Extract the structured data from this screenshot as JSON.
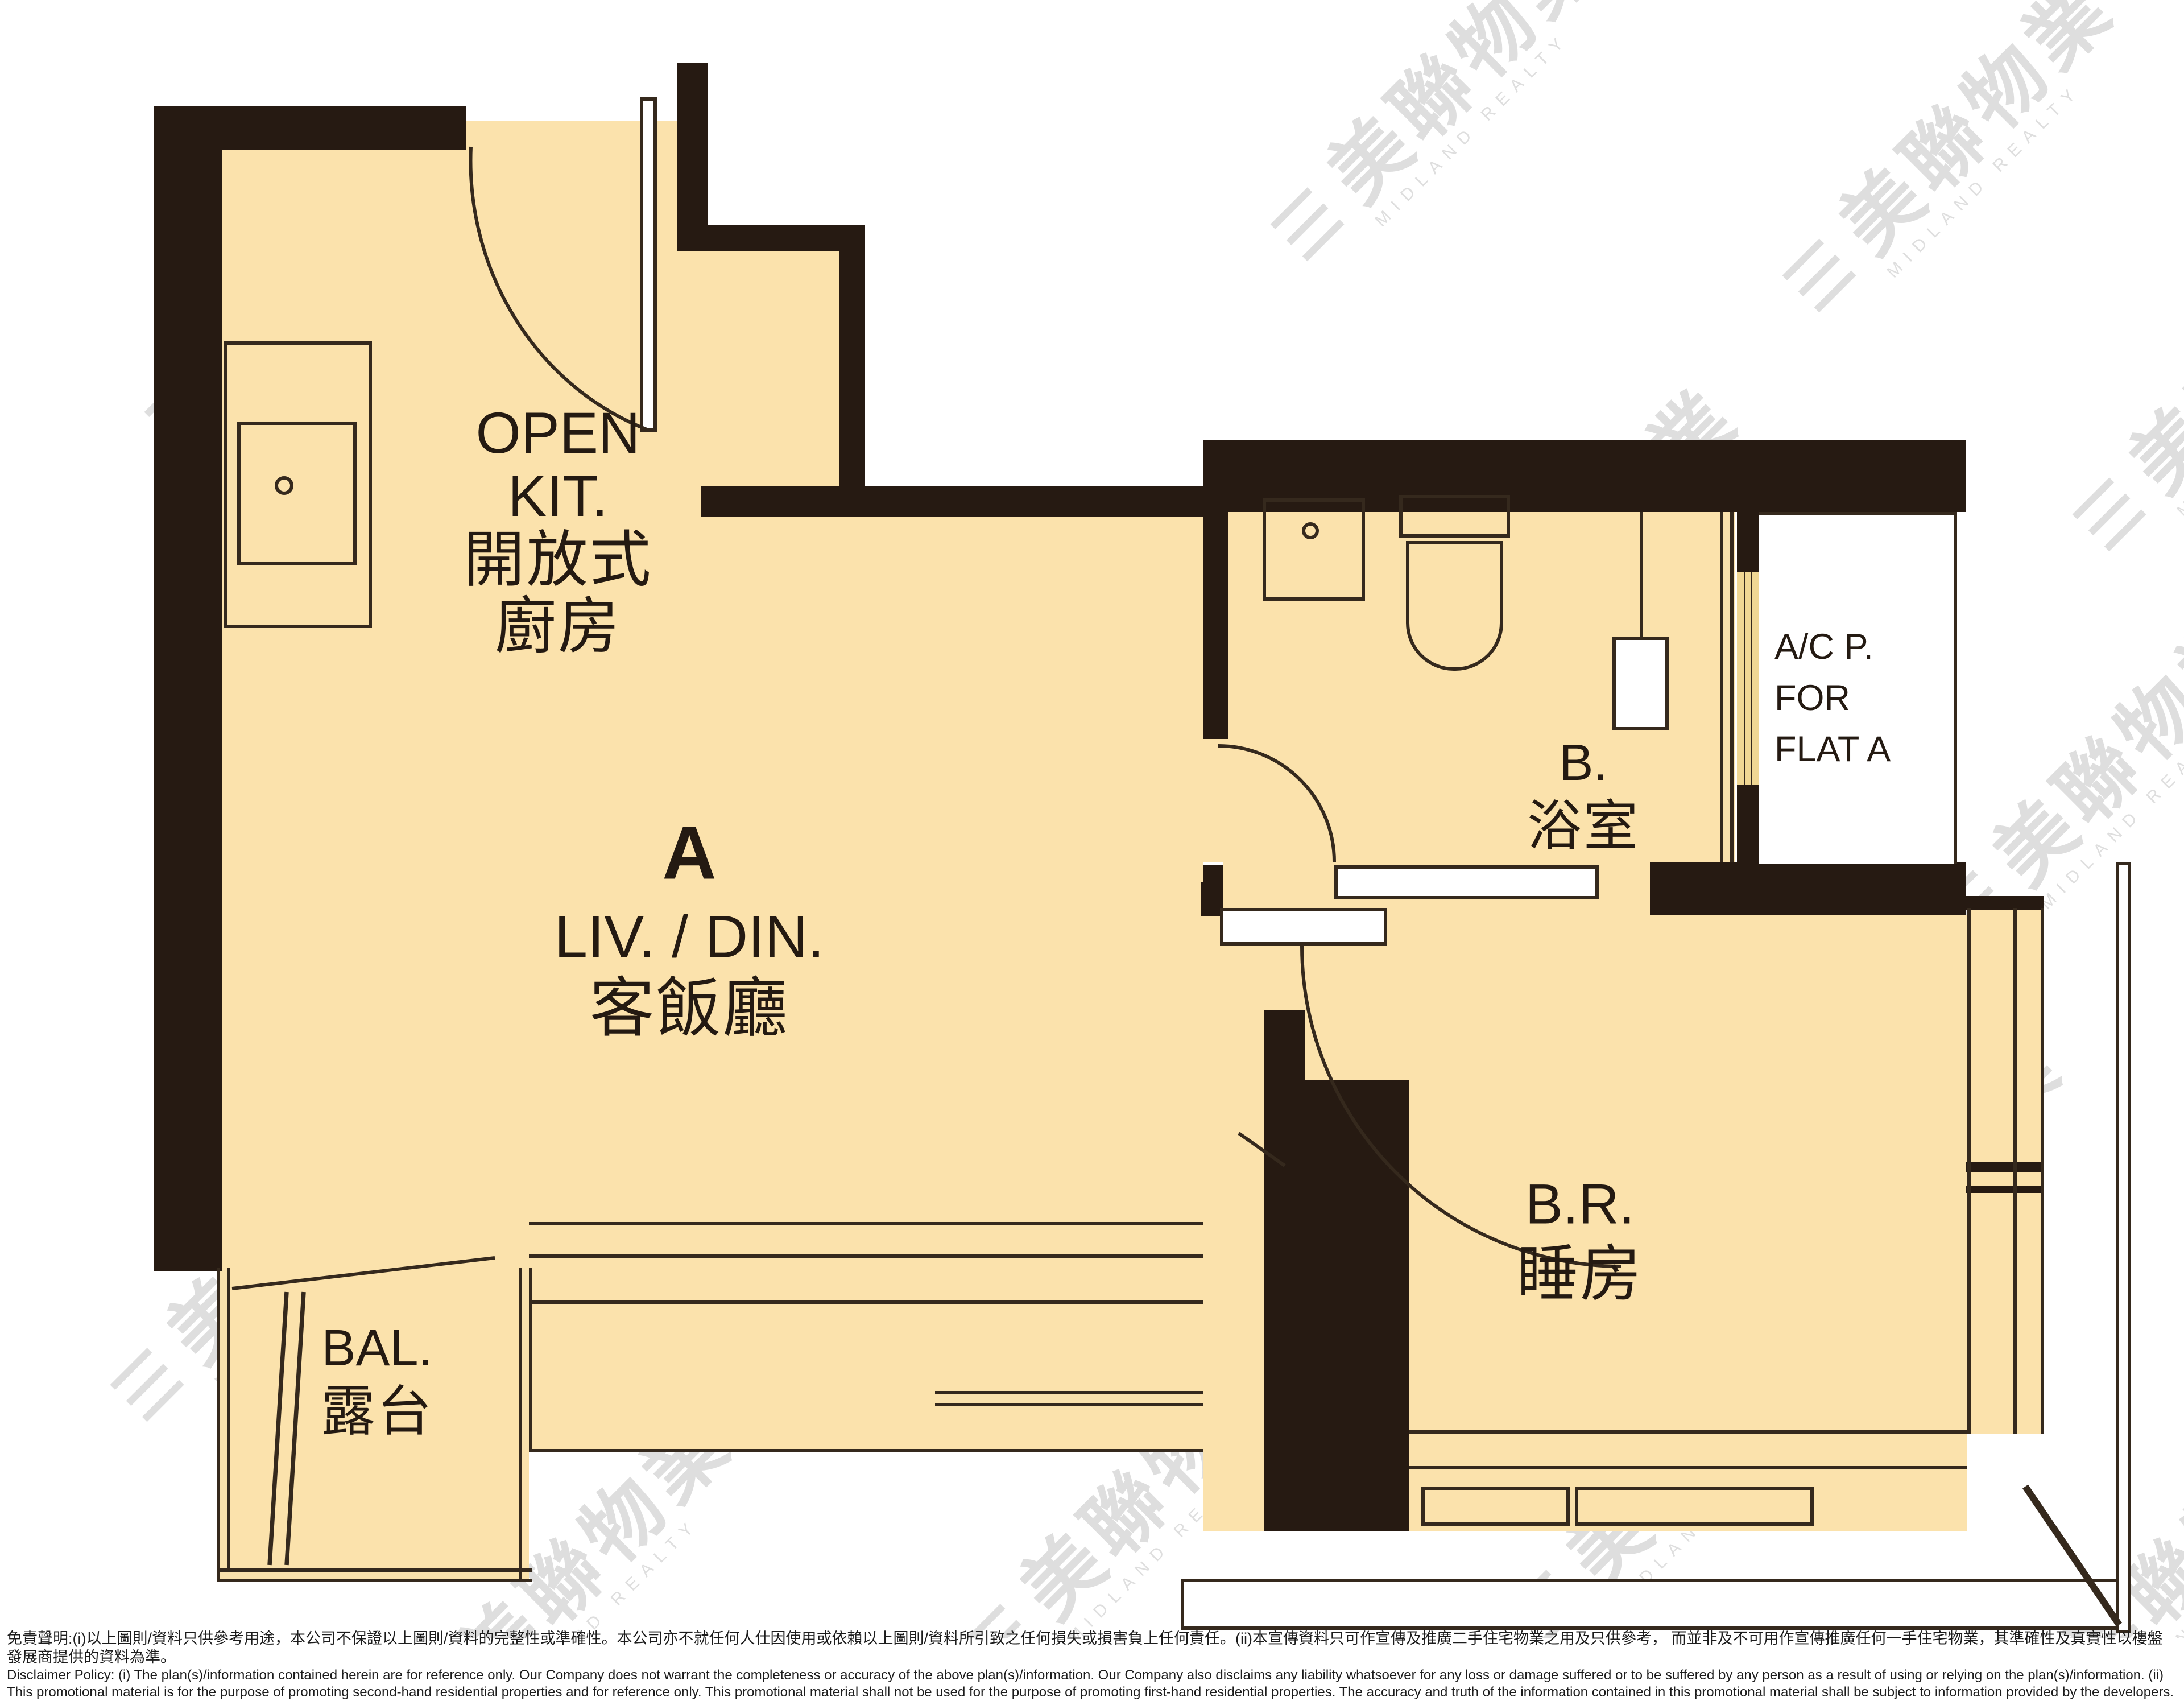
{
  "floor_plan": {
    "rooms": {
      "open_kitchen": {
        "en1": "OPEN",
        "en2": "KIT.",
        "zh1": "開放式",
        "zh2": "廚房"
      },
      "living_dining": {
        "unit": "A",
        "en": "LIV. / DIN.",
        "zh": "客飯廳"
      },
      "bathroom": {
        "en": "B.",
        "zh": "浴室"
      },
      "bedroom": {
        "en": "B.R.",
        "zh": "睡房"
      },
      "balcony": {
        "en": "BAL.",
        "zh": "露台"
      },
      "ac_platform": {
        "line1": "A/C P.",
        "line2": "FOR",
        "line3": "FLAT A"
      }
    }
  },
  "watermark": {
    "bars": "☰",
    "cjk": "美聯物業",
    "latin": "MIDLAND REALTY"
  },
  "disclaimer": {
    "zh": "免責聲明:(i)以上圖則/資料只供參考用途，本公司不保證以上圖則/資料的完整性或準確性。本公司亦不就任何人仕因使用或依賴以上圖則/資料所引致之任何損失或損害負上任何責任。(ii)本宣傳資料只可作宣傳及推廣二手住宅物業之用及只供參考， 而並非及不可用作宣傳推廣任何一手住宅物業，其準確性及真實性以樓盤發展商提供的資料為準。",
    "en": "Disclaimer Policy: (i) The plan(s)/information contained herein are for reference only. Our Company does not warrant the completeness or accuracy of the above plan(s)/information. Our Company also disclaims any liability whatsoever for any loss or damage suffered or to be suffered by any person as a result of using or relying on the plan(s)/information. (ii) This promotional material is for the purpose of promoting second-hand residential properties and for reference only. This promotional material shall not be used for the purpose of promoting first-hand residential properties. The accuracy and truth of the information contained in this promotional material shall be subject to information provided by the developers."
  },
  "colors": {
    "floor": "#fbe2ac",
    "wall": "#261a12",
    "line": "#35291d",
    "louvre": "#f0d794",
    "watermark": "#c6c6c6"
  }
}
